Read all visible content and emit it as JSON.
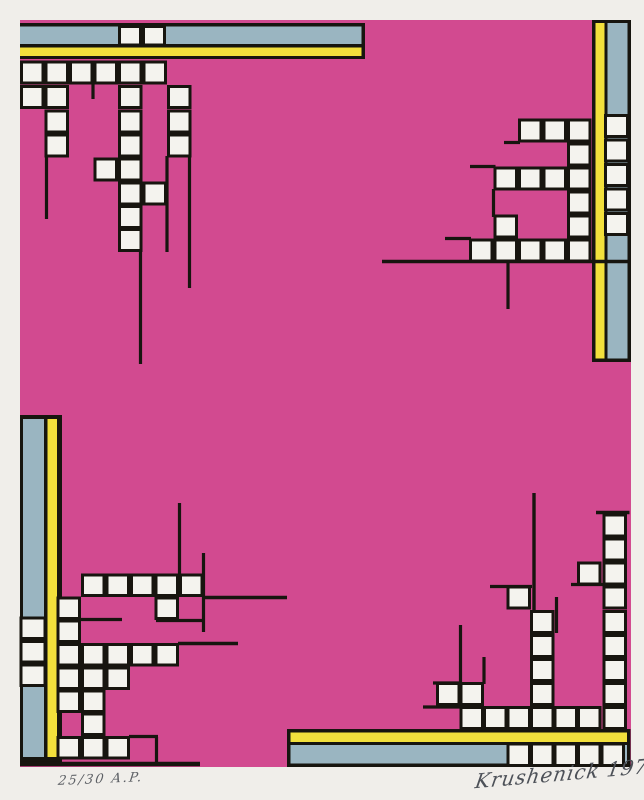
{
  "inscriptions": {
    "edition_left": "25/30 A.P.",
    "signature_right": "Krushenick 1978"
  },
  "palette": {
    "paper": "#f0eeea",
    "pink": "#d24a90",
    "blue": "#9ab5c1",
    "yellow": "#f2e03c",
    "line": "#17150f",
    "tile": "#f4f3ee"
  },
  "geometry": {
    "canvas": [
      644,
      800
    ],
    "print": [
      20,
      20,
      611,
      747
    ],
    "bars": [
      {
        "name": "top-bar",
        "rects": [
          [
            20,
            23,
            345,
            36,
            "black"
          ],
          [
            20,
            26.5,
            341.5,
            17.5,
            "blue"
          ],
          [
            20,
            47.5,
            341.5,
            8.5,
            "yellow"
          ]
        ]
      },
      {
        "name": "right-bar",
        "rects": [
          [
            592,
            20,
            39,
            342,
            "black"
          ],
          [
            595.5,
            23,
            9,
            335.5,
            "yellow"
          ],
          [
            607.5,
            23,
            20,
            335.5,
            "blue"
          ]
        ]
      },
      {
        "name": "left-bar",
        "rects": [
          [
            20,
            415,
            42,
            347,
            "black"
          ],
          [
            23,
            419,
            21,
            338,
            "blue"
          ],
          [
            47.5,
            419,
            9.5,
            338,
            "yellow"
          ]
        ]
      },
      {
        "name": "bottom-bar",
        "rects": [
          [
            287,
            729,
            343.5,
            38,
            "black"
          ],
          [
            290.5,
            732.5,
            336.5,
            9.5,
            "yellow"
          ],
          [
            290.5,
            745,
            336.5,
            18.5,
            "blue"
          ]
        ]
      }
    ],
    "clusters": [
      {
        "name": "top-left-tiles",
        "w": 21.5,
        "h": 21,
        "squares": [
          [
            21.5,
            62
          ],
          [
            46,
            62
          ],
          [
            70.5,
            62
          ],
          [
            95,
            62
          ],
          [
            119.5,
            62
          ],
          [
            144,
            62
          ],
          [
            21.5,
            86.5
          ],
          [
            46,
            86.5
          ],
          [
            119.5,
            86.5
          ],
          [
            168.5,
            86.5
          ],
          [
            46,
            111
          ],
          [
            119.5,
            111
          ],
          [
            168.5,
            111
          ],
          [
            46,
            135
          ],
          [
            119.5,
            135
          ],
          [
            168.5,
            135
          ],
          [
            95,
            159
          ],
          [
            119.5,
            159
          ],
          [
            119.5,
            183
          ],
          [
            144,
            183
          ],
          [
            119.5,
            206.5
          ],
          [
            119.5,
            229.5
          ]
        ]
      },
      {
        "name": "top-bar-tiles",
        "w": 21,
        "h": 18.5,
        "squares": [
          [
            119.5,
            26.5
          ],
          [
            143.5,
            26.5
          ]
        ]
      },
      {
        "name": "top-right-tiles",
        "w": 21.5,
        "h": 21,
        "squares": [
          [
            519.5,
            120
          ],
          [
            544,
            120
          ],
          [
            568.5,
            120
          ],
          [
            568.5,
            144
          ],
          [
            495,
            168
          ],
          [
            519.5,
            168
          ],
          [
            544,
            168
          ],
          [
            568.5,
            168
          ],
          [
            568.5,
            192
          ],
          [
            495,
            216
          ],
          [
            568.5,
            216
          ],
          [
            470.5,
            240
          ],
          [
            495,
            240
          ],
          [
            519.5,
            240
          ],
          [
            544,
            240
          ],
          [
            568.5,
            240
          ]
        ]
      },
      {
        "name": "right-bar-tiles",
        "w": 22,
        "h": 21,
        "squares": [
          [
            605.5,
            115.5
          ],
          [
            605.5,
            140
          ],
          [
            605.5,
            164.5
          ],
          [
            605.5,
            189
          ],
          [
            605.5,
            213.5
          ]
        ]
      },
      {
        "name": "bottom-left-tiles",
        "w": 21.5,
        "h": 20.5,
        "squares": [
          [
            82.5,
            575
          ],
          [
            107,
            575
          ],
          [
            131.5,
            575
          ],
          [
            156,
            575
          ],
          [
            180.5,
            575
          ],
          [
            58,
            598
          ],
          [
            156,
            598
          ],
          [
            58,
            621
          ],
          [
            58,
            644.5
          ],
          [
            82.5,
            644.5
          ],
          [
            107,
            644.5
          ],
          [
            131.5,
            644.5
          ],
          [
            156,
            644.5
          ],
          [
            58,
            668
          ],
          [
            82.5,
            668
          ],
          [
            107,
            668
          ],
          [
            58,
            691
          ],
          [
            82.5,
            691
          ],
          [
            82.5,
            714
          ],
          [
            58,
            737.5
          ],
          [
            82.5,
            737.5
          ],
          [
            107,
            737.5
          ]
        ]
      },
      {
        "name": "left-bar-tiles",
        "w": 24,
        "h": 20.5,
        "squares": [
          [
            21,
            618
          ],
          [
            21,
            641.5
          ],
          [
            21,
            665
          ]
        ]
      },
      {
        "name": "bottom-right-tiles",
        "w": 21.5,
        "h": 21,
        "squares": [
          [
            604,
            515
          ],
          [
            604,
            539
          ],
          [
            604,
            563
          ],
          [
            604,
            587
          ],
          [
            604,
            611.5
          ],
          [
            604,
            635.5
          ],
          [
            604,
            659.5
          ],
          [
            604,
            683.5
          ],
          [
            578.5,
            563
          ],
          [
            508,
            587
          ],
          [
            531.5,
            611.5
          ],
          [
            531.5,
            635.5
          ],
          [
            531.5,
            659.5
          ],
          [
            531.5,
            683.5
          ],
          [
            437.5,
            683.5
          ],
          [
            461,
            683.5
          ],
          [
            461,
            707.5
          ],
          [
            484.5,
            707.5
          ],
          [
            508,
            707.5
          ],
          [
            531.5,
            707.5
          ],
          [
            555,
            707.5
          ],
          [
            578.5,
            707.5
          ],
          [
            604,
            707.5
          ]
        ]
      },
      {
        "name": "bottom-bar-tiles",
        "w": 21.5,
        "h": 21.5,
        "squares": [
          [
            508,
            744
          ],
          [
            531.5,
            744
          ],
          [
            555,
            744
          ],
          [
            578.5,
            744
          ],
          [
            602,
            744
          ]
        ]
      }
    ],
    "lines": [
      [
        93,
        82,
        93,
        99,
        3.2
      ],
      [
        46.5,
        156,
        46.5,
        219,
        3.2
      ],
      [
        140.5,
        250,
        140.5,
        364,
        3.2
      ],
      [
        167,
        156,
        167,
        252,
        3.2
      ],
      [
        189.5,
        156,
        189.5,
        288,
        3.2
      ],
      [
        504,
        142.5,
        520,
        142.5,
        3.2
      ],
      [
        470,
        166.5,
        495.5,
        166.5,
        3.2
      ],
      [
        493.5,
        189,
        493.5,
        217,
        3.2
      ],
      [
        445,
        238.5,
        471,
        238.5,
        3.2
      ],
      [
        382,
        261.5,
        629.5,
        261.5,
        3.6
      ],
      [
        508,
        262,
        508,
        309,
        3.2
      ],
      [
        179.5,
        503,
        179.5,
        576,
        3.2
      ],
      [
        203.5,
        553,
        203.5,
        632,
        3.2
      ],
      [
        203,
        597.5,
        287,
        597.5,
        3.6
      ],
      [
        156,
        620.5,
        203,
        620.5,
        3.2
      ],
      [
        80,
        619.5,
        122,
        619.5,
        3.2
      ],
      [
        178,
        643.5,
        238,
        643.5,
        3.6
      ],
      [
        129,
        736.5,
        158,
        736.5,
        3.2
      ],
      [
        156.5,
        737,
        156.5,
        762,
        3.2
      ],
      [
        20,
        764,
        200,
        764,
        4.5
      ],
      [
        534,
        493,
        534,
        612,
        3.4
      ],
      [
        596,
        512.5,
        629.5,
        512.5,
        3.4
      ],
      [
        571,
        584.5,
        604,
        584.5,
        3.2
      ],
      [
        490,
        586.5,
        532,
        586.5,
        3.2
      ],
      [
        556.5,
        597,
        556.5,
        633,
        3.2
      ],
      [
        460.5,
        625,
        460.5,
        684,
        3.2
      ],
      [
        433,
        683,
        461,
        683,
        3.2
      ],
      [
        484,
        657,
        484,
        684,
        3.2
      ],
      [
        423,
        707,
        461,
        707,
        3.2
      ]
    ]
  }
}
